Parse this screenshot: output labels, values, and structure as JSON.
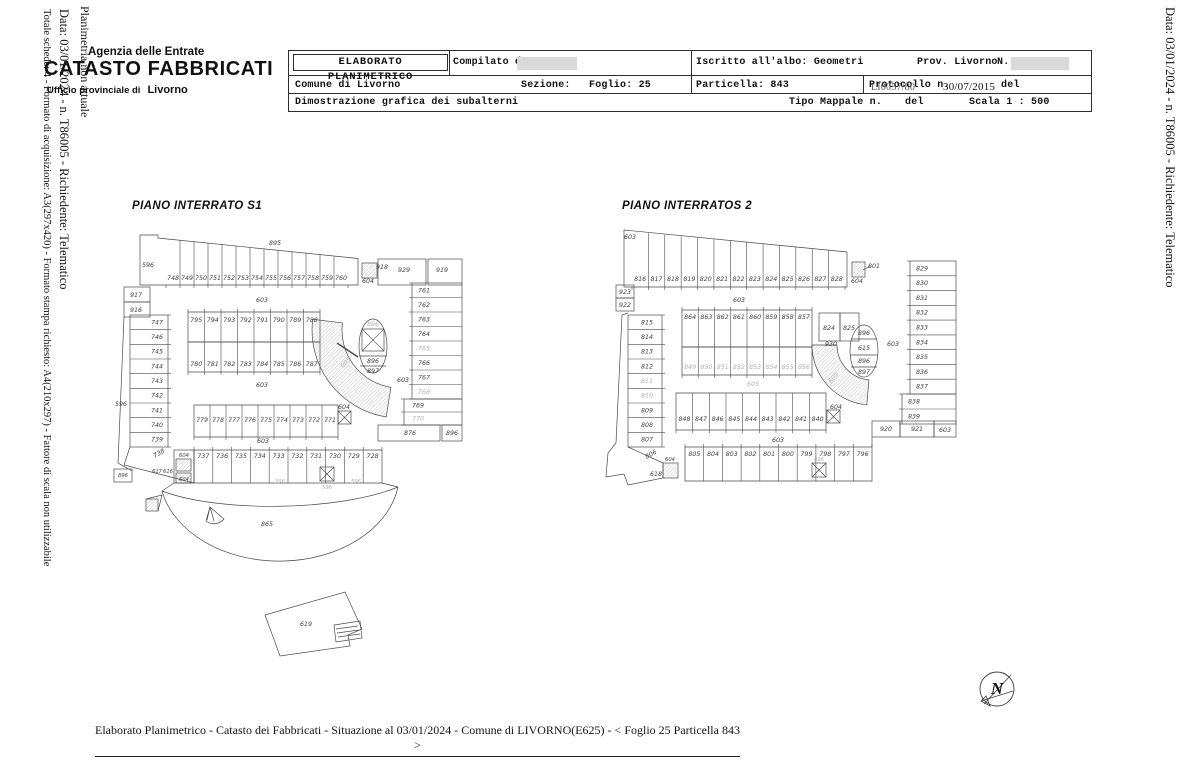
{
  "side_texts": {
    "left_1": "Planimetria non attuale",
    "left_2": "Data: 03/01/2024 - n. T86005 - Richiedente: Telematico",
    "left_3": "Totale schede: 4 - Formato di acquisizione: A3(297x420) - Formato stampa richiesto: A4(210x297) - Fattore di scala non utilizzabile",
    "right_1": "Data: 03/01/2024 - n. T86005 - Richiedente: Telematico"
  },
  "logo": {
    "agency": "Agenzia delle Entrate",
    "registry": "CATASTO FABBRICATI",
    "office": "Ufficio provinciale di",
    "city": "Livorno"
  },
  "header": {
    "elaborato": "ELABORATO PLANIMETRICO",
    "compilato": "Compilato da:",
    "iscritto": "Iscritto all'albo: Geometri",
    "prov": "Prov. Livorno",
    "n_label": "N.",
    "comune": "Comune di Livorno",
    "sezione": "Sezione:",
    "foglio": "Foglio: 25",
    "particella": "Particella: 843",
    "protocollo": "Protocollo n.",
    "protocollo_overlap": "LI0057/80",
    "protocollo_date": "30/07/2015",
    "del1": "del",
    "dimostrazione": "Dimostrazione grafica dei subalterni",
    "tipo_mappale": "Tipo Mappale n.",
    "del2": "del",
    "scala": "Scala 1 : 500"
  },
  "plan_s1": {
    "title": "PIANO INTERRATO S1",
    "rows": {
      "top": [
        "748",
        "749",
        "750",
        "751",
        "752",
        "753",
        "754",
        "755",
        "756",
        "757",
        "758",
        "759",
        "760"
      ],
      "left": [
        "747",
        "746",
        "745",
        "744",
        "743",
        "742",
        "741",
        "740",
        "739"
      ],
      "mid1": [
        "795",
        "794",
        "793",
        "792",
        "791",
        "790",
        "789",
        "788"
      ],
      "mid2": [
        "780",
        "781",
        "782",
        "783",
        "784",
        "785",
        "786",
        "787"
      ],
      "mid3": [
        "779",
        "778",
        "777",
        "776",
        "775",
        "774",
        "773",
        "772",
        "771"
      ],
      "right": [
        "761",
        "762",
        "763",
        "764",
        "765",
        "766",
        "767",
        "768",
        "769",
        "770"
      ],
      "bottom": [
        "737",
        "736",
        "735",
        "734",
        "733",
        "732",
        "731",
        "730",
        "729",
        "728"
      ]
    },
    "labels": {
      "l895": "895",
      "l596a": "596",
      "l917": "917",
      "l916": "916",
      "l596b": "596",
      "l896a": "896",
      "l604a": "604",
      "l918": "918",
      "l929": "929",
      "l919": "919",
      "c603a": "603",
      "c603b": "603",
      "c603c": "603",
      "c603d": "603",
      "ramp": "605",
      "oval_top": "896",
      "oval_mid": "896",
      "oval_bot": "897",
      "l604b": "604",
      "l738": "738",
      "l604c": "604",
      "l604d": "604",
      "l617": "617",
      "l616": "616",
      "l596c": "596",
      "l596d": "596",
      "l596e": "596",
      "l876": "876",
      "l896b": "896",
      "l865": "865",
      "l619": "619"
    }
  },
  "plan_s2": {
    "title": "PIANO INTERRATOS 2",
    "rows": {
      "top": [
        "816",
        "817",
        "818",
        "819",
        "820",
        "821",
        "822",
        "823",
        "824",
        "825",
        "826",
        "827",
        "828"
      ],
      "left": [
        "815",
        "814",
        "813",
        "812",
        "811",
        "810",
        "809",
        "808",
        "807"
      ],
      "mid1": [
        "864",
        "863",
        "862",
        "861",
        "860",
        "859",
        "858",
        "857"
      ],
      "mid2": [
        "849",
        "850",
        "851",
        "852",
        "853",
        "854",
        "855",
        "856"
      ],
      "mid3": [
        "848",
        "847",
        "846",
        "845",
        "844",
        "843",
        "842",
        "841",
        "840"
      ],
      "right": [
        "829",
        "830",
        "831",
        "832",
        "833",
        "834",
        "835",
        "836",
        "837",
        "838",
        "839"
      ],
      "bottom": [
        "805",
        "804",
        "803",
        "802",
        "801",
        "800",
        "799",
        "798",
        "797",
        "796"
      ]
    },
    "labels": {
      "l603tl": "603",
      "l923": "923",
      "l922": "922",
      "l604tr": "604",
      "l801": "801",
      "l824": "824",
      "l825": "825",
      "l930": "930",
      "oval_top": "896",
      "l615": "615",
      "oval_mid": "896",
      "oval_bot": "897",
      "c603a": "603",
      "c603b": "603",
      "c603r": "603",
      "c603br": "603",
      "ramp": "605",
      "l604m": "604",
      "l806": "806",
      "l618": "618",
      "l604b": "604",
      "l896x": "896",
      "l920": "920",
      "l921": "921",
      "l603box": "603"
    }
  },
  "north_label": "N",
  "footer": "Elaborato Planimetrico - Catasto dei Fabbricati - Situazione al 03/01/2024 - Comune di LIVORNO(E625) - < Foglio 25 Particella 843 >"
}
